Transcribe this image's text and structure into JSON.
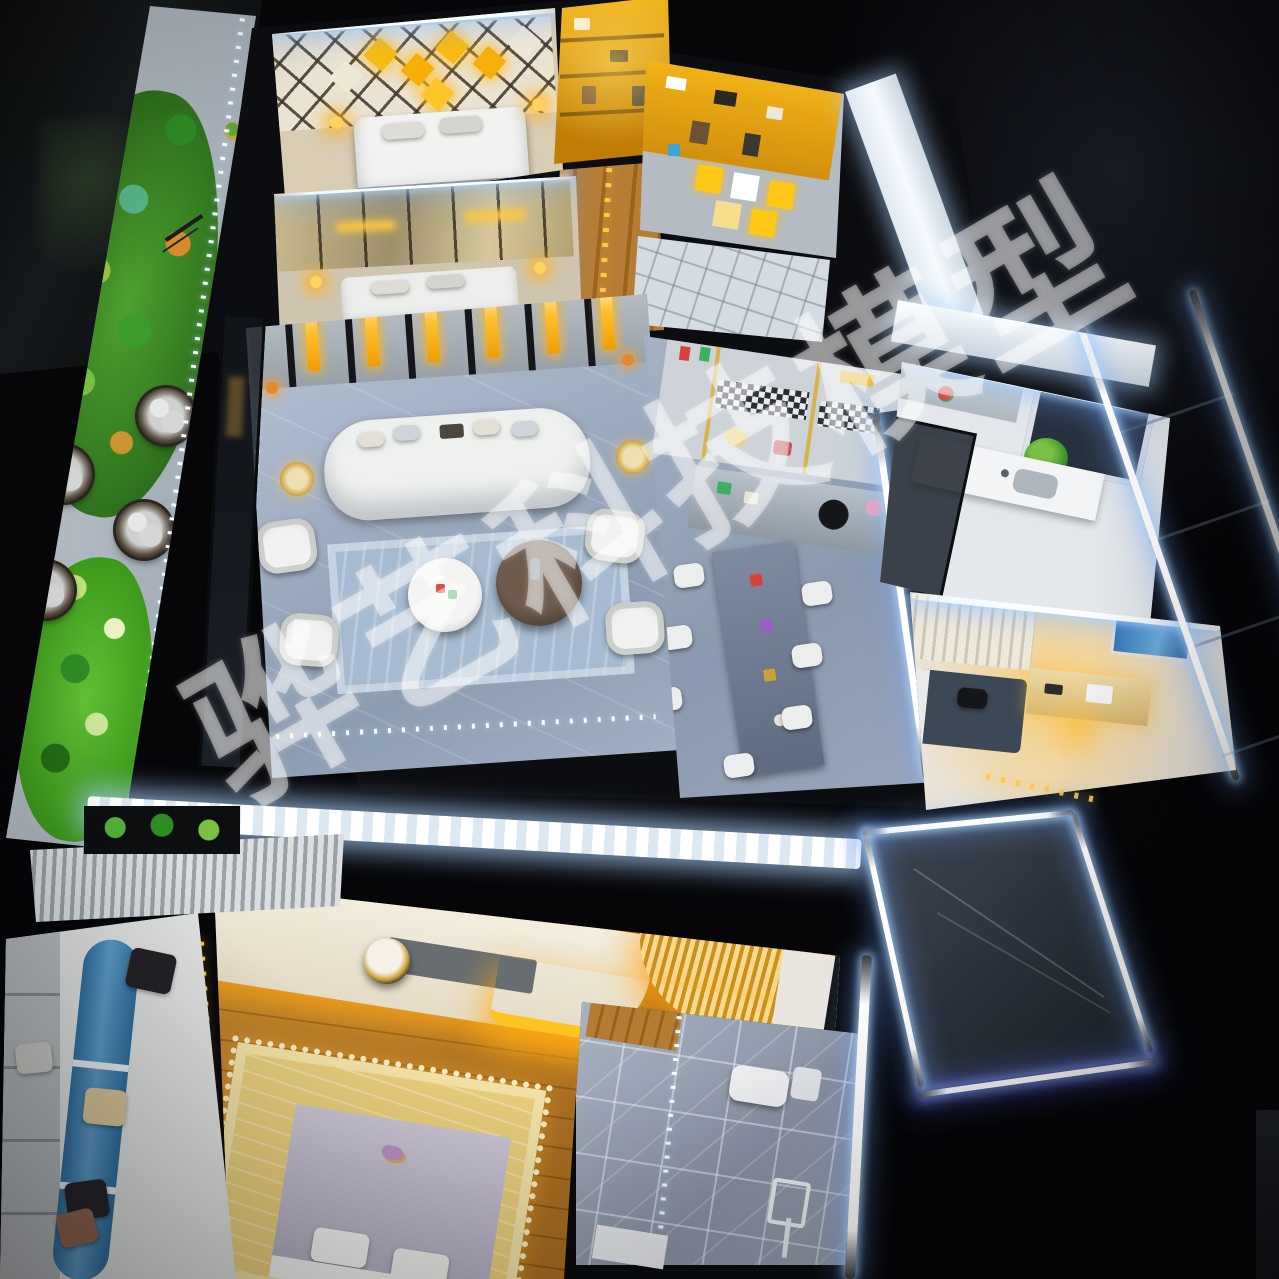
{
  "watermark": {
    "text": "骅艺科技模型"
  },
  "palette": {
    "bg": "#060609",
    "wall": "#0c0d10",
    "led": "#eaf6ff",
    "led-glow": "#9fd8ff",
    "gold": "#f3b40e",
    "gold-deep": "#c07d06",
    "amber-glow": "#ffc41f",
    "marble-a": "#bac6d8",
    "marble-b": "#8c9cb2",
    "wood": "#c3862f",
    "wood-deep": "#8f5a1b",
    "green": "#55b32e",
    "green-deep": "#2c6d1c",
    "sofa": "#eef0ee",
    "rug": "#a6bbd1",
    "glass": "#2b323c",
    "blue-fabric": "#3e7fb0",
    "watermark": "rgba(255,255,255,0.44)"
  }
}
